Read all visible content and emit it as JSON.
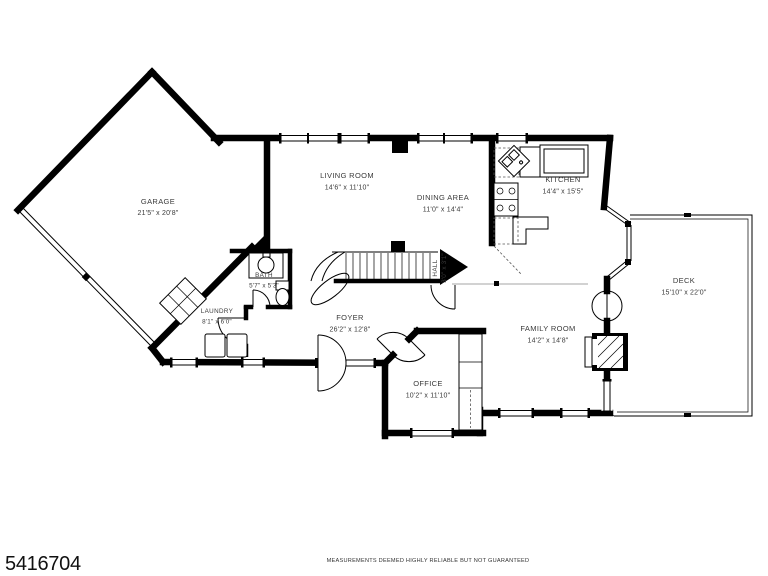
{
  "plan": {
    "rooms": [
      {
        "id": "garage",
        "name": "GARAGE",
        "dims": "21'5\" x 20'8\""
      },
      {
        "id": "living-room",
        "name": "LIVING ROOM",
        "dims": "14'6\" x 11'10\""
      },
      {
        "id": "dining-area",
        "name": "DINING AREA",
        "dims": "11'0\" x 14'4\""
      },
      {
        "id": "kitchen",
        "name": "KITCHEN",
        "dims": "14'4\" x 15'5\""
      },
      {
        "id": "deck",
        "name": "DECK",
        "dims": "15'10\" x 22'0\""
      },
      {
        "id": "bath",
        "name": "BATH",
        "dims": "5'7\" x 5'3\""
      },
      {
        "id": "laundry",
        "name": "LAUNDRY",
        "dims": "8'1\" x 6'0\""
      },
      {
        "id": "foyer",
        "name": "FOYER",
        "dims": "26'2\" x 12'8\""
      },
      {
        "id": "hall",
        "name": "HALL",
        "dims": "3'0\" x 3'1\""
      },
      {
        "id": "office",
        "name": "OFFICE",
        "dims": "10'2\" x 11'10\""
      },
      {
        "id": "family-room",
        "name": "FAMILY ROOM",
        "dims": "14'2\" x 14'8\""
      }
    ]
  },
  "footer": {
    "listing_id": "5416704",
    "disclaimer": "MEASUREMENTS DEEMED HIGHLY RELIABLE BUT NOT GUARANTEED"
  },
  "colors": {
    "walls": "#000000",
    "background": "#ffffff",
    "label_text": "#3a3a3a"
  }
}
